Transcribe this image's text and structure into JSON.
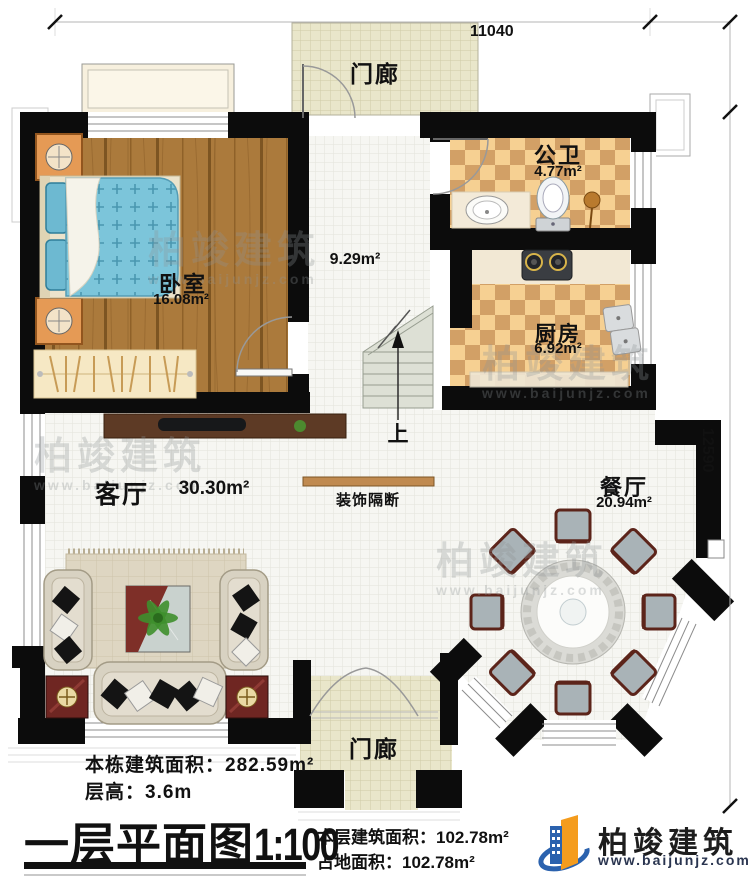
{
  "plan": {
    "dim_top": "11040",
    "dim_right": "12590"
  },
  "rooms": {
    "porch_top": {
      "name": "门廊"
    },
    "bedroom": {
      "name": "卧室",
      "area": "16.08m²"
    },
    "bathroom": {
      "name": "公卫",
      "area": "4.77m²"
    },
    "kitchen": {
      "name": "厨房",
      "area": "6.92m²"
    },
    "hallway": {
      "area": "9.29m²"
    },
    "living": {
      "name": "客厅",
      "area": "30.30m²"
    },
    "dining": {
      "name": "餐厅",
      "area": "20.94m²"
    },
    "porch_bottom": {
      "name": "门廊"
    },
    "stair": {
      "direction": "上"
    },
    "partition": {
      "label": "装饰隔断"
    }
  },
  "info": {
    "building_total_area": "本栋建筑面积：282.59m²",
    "floor_height": "层高：3.6m",
    "title": "一层平面图",
    "scale": "1:100",
    "floor_area": "本层建筑面积：102.78m²",
    "footprint_area": "占地面积：102.78m²"
  },
  "brand": {
    "name": "柏竣建筑",
    "website": "www.baijunjz.com"
  },
  "watermark": {
    "name": "柏竣建筑",
    "website": "www.baijunjz.com"
  },
  "colors": {
    "wall": "#0c0c0c",
    "wood_floor": "#ab7a3c",
    "tile_dark": "#d2a066",
    "tile_light": "#f6d092",
    "bed_blue": "#7cc5da",
    "partition": "#c08a50",
    "logo_blue": "#2b62ae",
    "logo_orange": "#f49c1e"
  }
}
